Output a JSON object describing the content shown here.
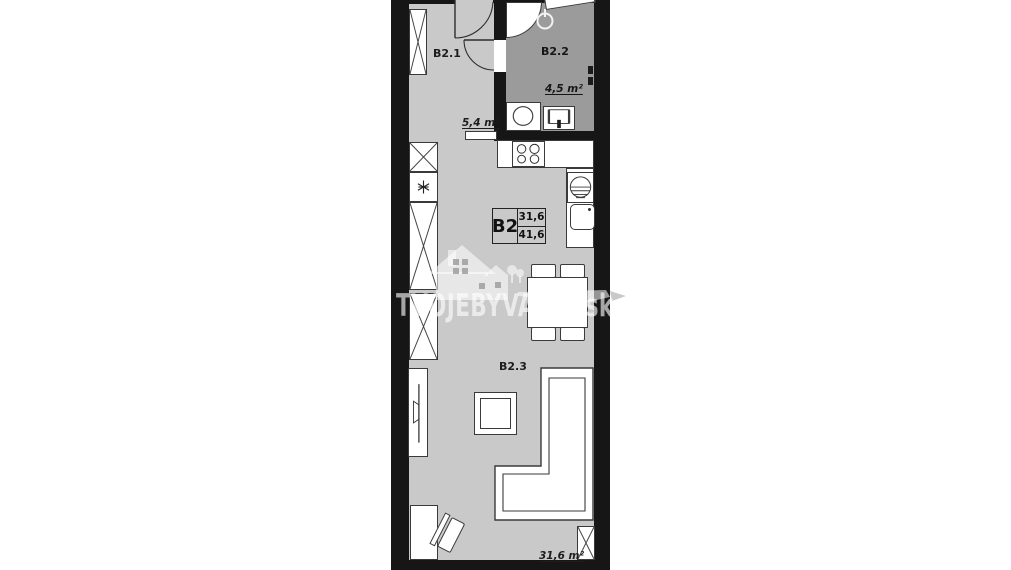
{
  "plan": {
    "unit_box": {
      "code": "B2",
      "area_top": "31,6",
      "area_bottom": "41,6"
    },
    "rooms": [
      {
        "id": "B2.1",
        "area": "5,4 m²"
      },
      {
        "id": "B2.2",
        "area": "4,5 m²"
      },
      {
        "id": "B2.3",
        "area": "31,6 m²"
      }
    ],
    "watermark": {
      "brand_light": "TVOJE",
      "brand_bold": "BYVANIE.sk"
    },
    "colors": {
      "floor": "#c9c9c9",
      "floor_bath": "#9b9b9b",
      "wall": "#161616"
    }
  }
}
